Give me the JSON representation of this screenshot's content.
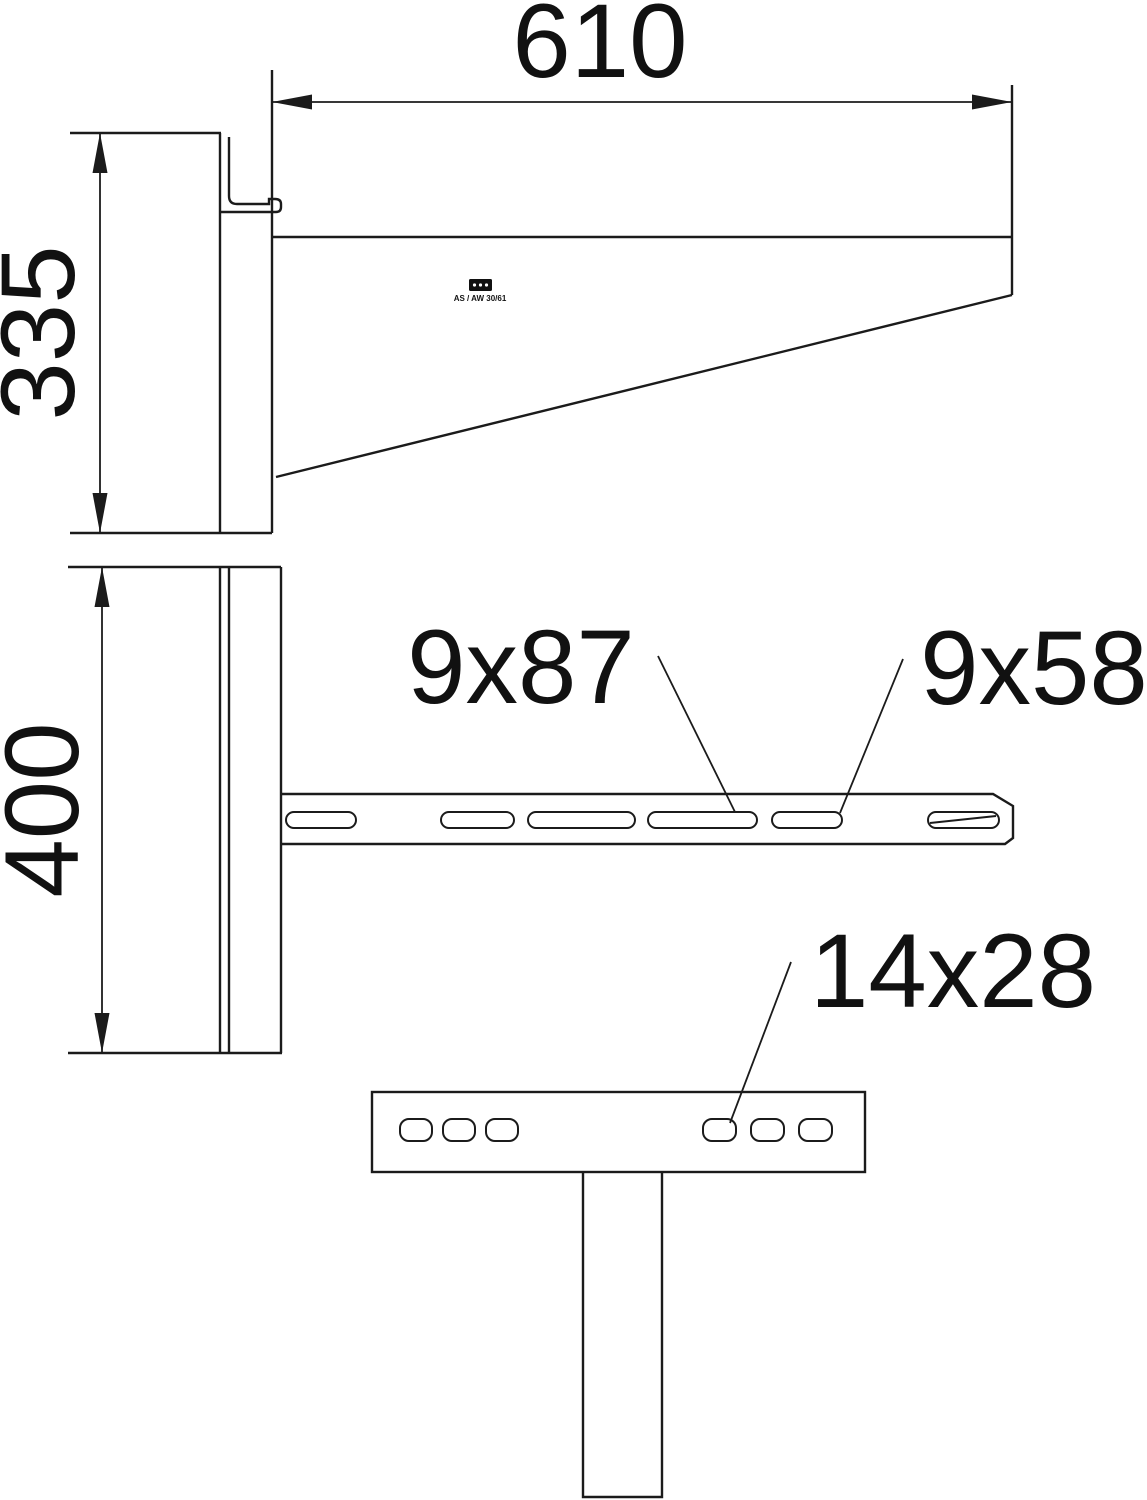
{
  "page": {
    "background_color": "#ffffff",
    "line_color": "#1b1b1b"
  },
  "views": {
    "side_view": {
      "dim_arm_length": "610",
      "dim_height": "335",
      "stamp_logo": "OBO",
      "stamp_text": "AS / AW 30/61"
    },
    "front_view": {
      "dim_plate_height": "400",
      "label_long_slot": "9x87",
      "label_short_slot": "9x58"
    },
    "base_view": {
      "label_base_hole": "14x28"
    }
  }
}
